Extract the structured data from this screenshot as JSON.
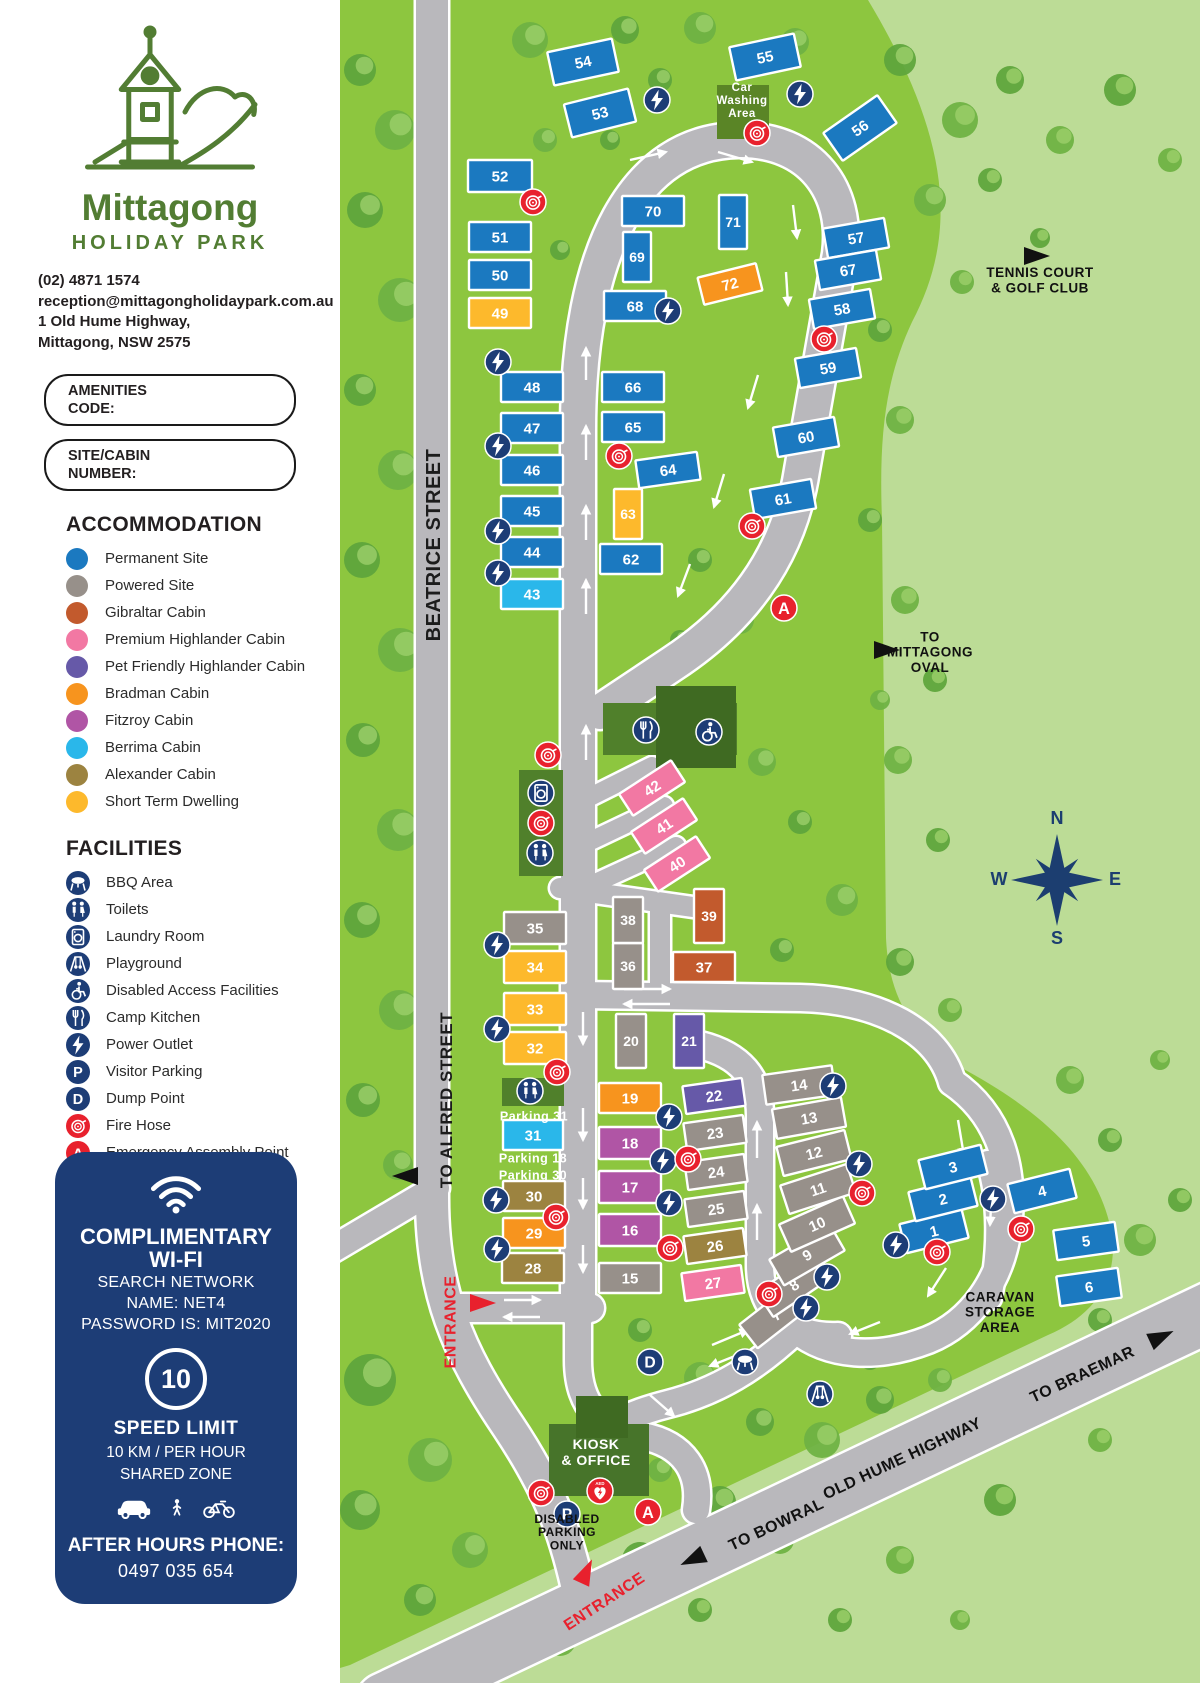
{
  "brand": {
    "name": "Mittagong",
    "subtitle": "HOLIDAY PARK",
    "phone": "(02) 4871 1574",
    "email": "reception@mittagongholidaypark.com.au",
    "address1": "1 Old Hume Highway,",
    "address2": "Mittagong, NSW 2575"
  },
  "forms": {
    "amenities_label": "AMENITIES\nCODE:",
    "site_label": "SITE/CABIN\nNUMBER:"
  },
  "legend": {
    "accommodation_title": "ACCOMMODATION",
    "accommodation": [
      {
        "label": "Permanent Site",
        "color": "#1b79c0"
      },
      {
        "label": "Powered Site",
        "color": "#97908a"
      },
      {
        "label": "Gibraltar Cabin",
        "color": "#c25a2d"
      },
      {
        "label": "Premium Highlander Cabin",
        "color": "#f278a3"
      },
      {
        "label": "Pet Friendly Highlander Cabin",
        "color": "#6659a8"
      },
      {
        "label": "Bradman Cabin",
        "color": "#f7941e"
      },
      {
        "label": "Fitzroy Cabin",
        "color": "#b055a5"
      },
      {
        "label": "Berrima Cabin",
        "color": "#2ab7ea"
      },
      {
        "label": "Alexander Cabin",
        "color": "#9c8340"
      },
      {
        "label": "Short Term Dwelling",
        "color": "#fdb92c"
      }
    ],
    "facilities_title": "FACILITIES",
    "facilities": [
      {
        "label": "BBQ Area",
        "icon": "bbq",
        "color": "#1d3d76"
      },
      {
        "label": "Toilets",
        "icon": "toilets",
        "color": "#1d3d76"
      },
      {
        "label": "Laundry Room",
        "icon": "laundry",
        "color": "#1d3d76"
      },
      {
        "label": "Playground",
        "icon": "playground",
        "color": "#1d3d76"
      },
      {
        "label": "Disabled Access Facilities",
        "icon": "disabled",
        "color": "#1d3d76"
      },
      {
        "label": "Camp Kitchen",
        "icon": "kitchen",
        "color": "#1d3d76"
      },
      {
        "label": "Power Outlet",
        "icon": "power",
        "color": "#1d3d76"
      },
      {
        "label": "Visitor Parking",
        "icon": "parking",
        "color": "#1d3d76"
      },
      {
        "label": "Dump Point",
        "icon": "dump",
        "color": "#1d3d76"
      },
      {
        "label": "Fire Hose",
        "icon": "fire",
        "color": "#e8212d"
      },
      {
        "label": "Emergency Assembly Point",
        "icon": "assembly",
        "color": "#e8212d"
      },
      {
        "label": "Defibrillator",
        "icon": "defib",
        "color": "#e8212d"
      }
    ]
  },
  "wifi_card": {
    "title": "COMPLIMENTARY\nWI-FI",
    "line1": "SEARCH NETWORK",
    "line2": "NAME: NET4",
    "line3": "PASSWORD IS: MIT2020",
    "speed_value": "10",
    "speed_title": "SPEED LIMIT",
    "speed_line1": "10 KM / PER HOUR",
    "speed_line2": "SHARED ZONE",
    "after_hours_label": "AFTER HOURS PHONE:",
    "after_hours_phone": "0497 035 654"
  },
  "map": {
    "site_colors": {
      "permanent": "#1b79c0",
      "powered": "#97908a",
      "gibraltar": "#c25a2d",
      "premium": "#f278a3",
      "pet": "#6659a8",
      "bradman": "#f7941e",
      "fitzroy": "#b055a5",
      "berrima": "#2ab7ea",
      "alexander": "#9c8340",
      "short": "#fdb92c"
    },
    "sites": [
      [
        1,
        "permanent",
        934,
        1231,
        64,
        30,
        -14
      ],
      [
        2,
        "permanent",
        943,
        1199,
        64,
        30,
        -14
      ],
      [
        3,
        "permanent",
        953,
        1167,
        64,
        30,
        -14
      ],
      [
        4,
        "permanent",
        1042,
        1191,
        64,
        30,
        -14
      ],
      [
        5,
        "permanent",
        1086,
        1241,
        62,
        30,
        -8
      ],
      [
        6,
        "permanent",
        1089,
        1287,
        62,
        30,
        -8
      ],
      [
        7,
        "powered",
        776,
        1315,
        70,
        30,
        -38
      ],
      [
        8,
        "powered",
        794,
        1285,
        70,
        30,
        -34
      ],
      [
        9,
        "powered",
        807,
        1255,
        70,
        30,
        -30
      ],
      [
        10,
        "powered",
        817,
        1224,
        70,
        30,
        -24
      ],
      [
        11,
        "powered",
        818,
        1189,
        70,
        30,
        -18
      ],
      [
        12,
        "powered",
        814,
        1153,
        70,
        30,
        -14
      ],
      [
        13,
        "powered",
        809,
        1118,
        70,
        30,
        -10
      ],
      [
        14,
        "powered",
        799,
        1085,
        70,
        30,
        -8
      ],
      [
        15,
        "powered",
        630,
        1278,
        62,
        30,
        0
      ],
      [
        16,
        "fitzroy",
        630,
        1230,
        62,
        32,
        0
      ],
      [
        17,
        "fitzroy",
        630,
        1187,
        62,
        32,
        0
      ],
      [
        18,
        "fitzroy",
        630,
        1143,
        62,
        32,
        0
      ],
      [
        19,
        "bradman",
        630,
        1098,
        62,
        30,
        0
      ],
      [
        20,
        "powered",
        631,
        1041,
        30,
        54,
        0
      ],
      [
        21,
        "pet",
        689,
        1041,
        30,
        54,
        0
      ],
      [
        22,
        "pet",
        714,
        1096,
        60,
        28,
        -8
      ],
      [
        23,
        "powered",
        715,
        1133,
        60,
        28,
        -8
      ],
      [
        24,
        "powered",
        716,
        1172,
        60,
        28,
        -8
      ],
      [
        25,
        "powered",
        716,
        1209,
        60,
        28,
        -8
      ],
      [
        26,
        "alexander",
        715,
        1246,
        60,
        28,
        -8
      ],
      [
        27,
        "premium",
        713,
        1283,
        60,
        28,
        -8
      ],
      [
        28,
        "alexander",
        533,
        1268,
        62,
        30,
        0
      ],
      [
        29,
        "bradman",
        534,
        1233,
        62,
        30,
        0
      ],
      [
        30,
        "alexander",
        534,
        1196,
        62,
        30,
        0
      ],
      [
        31,
        "berrima",
        533,
        1135,
        60,
        30,
        0
      ],
      [
        32,
        "short",
        535,
        1048,
        62,
        32,
        0
      ],
      [
        33,
        "short",
        535,
        1009,
        62,
        32,
        0
      ],
      [
        34,
        "short",
        535,
        967,
        62,
        32,
        0
      ],
      [
        35,
        "powered",
        535,
        928,
        62,
        32,
        0
      ],
      [
        36,
        "powered",
        628,
        966,
        30,
        46,
        0
      ],
      [
        37,
        "gibraltar",
        704,
        967,
        62,
        30,
        0
      ],
      [
        38,
        "powered",
        628,
        920,
        30,
        46,
        0
      ],
      [
        39,
        "gibraltar",
        709,
        916,
        30,
        54,
        0
      ],
      [
        40,
        "premium",
        677,
        864,
        62,
        26,
        -33
      ],
      [
        41,
        "premium",
        664,
        826,
        62,
        26,
        -33
      ],
      [
        42,
        "premium",
        652,
        788,
        62,
        26,
        -33
      ],
      [
        43,
        "berrima",
        532,
        594,
        62,
        30,
        0
      ],
      [
        44,
        "permanent",
        532,
        552,
        62,
        30,
        0
      ],
      [
        45,
        "permanent",
        532,
        511,
        62,
        30,
        0
      ],
      [
        46,
        "permanent",
        532,
        470,
        62,
        30,
        0
      ],
      [
        47,
        "permanent",
        532,
        428,
        62,
        30,
        0
      ],
      [
        48,
        "permanent",
        532,
        387,
        62,
        30,
        0
      ],
      [
        49,
        "short",
        500,
        313,
        62,
        30,
        0
      ],
      [
        50,
        "permanent",
        500,
        275,
        62,
        30,
        0
      ],
      [
        51,
        "permanent",
        500,
        237,
        62,
        30,
        0
      ],
      [
        52,
        "permanent",
        500,
        176,
        64,
        32,
        0
      ],
      [
        53,
        "permanent",
        600,
        113,
        66,
        34,
        -14
      ],
      [
        54,
        "permanent",
        583,
        62,
        66,
        34,
        -12
      ],
      [
        55,
        "permanent",
        765,
        57,
        66,
        34,
        -12
      ],
      [
        56,
        "permanent",
        860,
        128,
        66,
        34,
        -35
      ],
      [
        57,
        "permanent",
        856,
        238,
        62,
        30,
        -10
      ],
      [
        58,
        "permanent",
        842,
        309,
        62,
        30,
        -10
      ],
      [
        59,
        "permanent",
        828,
        368,
        62,
        30,
        -10
      ],
      [
        60,
        "permanent",
        806,
        437,
        62,
        30,
        -10
      ],
      [
        61,
        "permanent",
        783,
        499,
        62,
        30,
        -10
      ],
      [
        62,
        "permanent",
        631,
        559,
        62,
        30,
        0
      ],
      [
        63,
        "short",
        628,
        514,
        28,
        50,
        0
      ],
      [
        64,
        "permanent",
        668,
        470,
        62,
        28,
        -8
      ],
      [
        65,
        "permanent",
        633,
        427,
        62,
        30,
        0
      ],
      [
        66,
        "permanent",
        633,
        387,
        62,
        30,
        0
      ],
      [
        67,
        "permanent",
        848,
        270,
        62,
        30,
        -10
      ],
      [
        68,
        "permanent",
        635,
        306,
        62,
        30,
        0
      ],
      [
        69,
        "permanent",
        637,
        257,
        28,
        50,
        0
      ],
      [
        70,
        "permanent",
        653,
        211,
        62,
        30,
        0
      ],
      [
        71,
        "permanent",
        733,
        222,
        28,
        54,
        0
      ],
      [
        72,
        "bradman",
        730,
        284,
        60,
        28,
        -14
      ]
    ],
    "icons": [
      [
        "power",
        657,
        100
      ],
      [
        "power",
        800,
        94
      ],
      [
        "power",
        668,
        311
      ],
      [
        "power",
        498,
        362
      ],
      [
        "power",
        498,
        446
      ],
      [
        "power",
        498,
        531
      ],
      [
        "power",
        498,
        573
      ],
      [
        "power",
        497,
        945
      ],
      [
        "power",
        497,
        1029
      ],
      [
        "power",
        496,
        1200
      ],
      [
        "power",
        497,
        1249
      ],
      [
        "power",
        669,
        1117
      ],
      [
        "power",
        663,
        1161
      ],
      [
        "power",
        669,
        1203
      ],
      [
        "power",
        833,
        1086
      ],
      [
        "power",
        859,
        1164
      ],
      [
        "power",
        827,
        1277
      ],
      [
        "power",
        806,
        1308
      ],
      [
        "power",
        896,
        1245
      ],
      [
        "power",
        993,
        1199
      ],
      [
        "fire",
        757,
        133
      ],
      [
        "fire",
        533,
        202
      ],
      [
        "fire",
        824,
        339
      ],
      [
        "fire",
        619,
        456
      ],
      [
        "fire",
        752,
        526
      ],
      [
        "fire",
        548,
        755
      ],
      [
        "fire",
        541,
        823
      ],
      [
        "fire",
        557,
        1072
      ],
      [
        "fire",
        688,
        1159
      ],
      [
        "fire",
        556,
        1217
      ],
      [
        "fire",
        670,
        1248
      ],
      [
        "fire",
        769,
        1294
      ],
      [
        "fire",
        862,
        1193
      ],
      [
        "fire",
        937,
        1252
      ],
      [
        "fire",
        1021,
        1229
      ],
      [
        "fire",
        541,
        1493
      ],
      [
        "toilets",
        540,
        853
      ],
      [
        "toilets",
        530,
        1091
      ],
      [
        "laundry",
        541,
        793
      ],
      [
        "kitchen",
        646,
        730
      ],
      [
        "disabled",
        709,
        732
      ],
      [
        "assembly",
        784,
        608
      ],
      [
        "assembly",
        648,
        1512
      ],
      [
        "defib",
        600,
        1491
      ],
      [
        "parking",
        567,
        1514
      ],
      [
        "dump",
        650,
        1362
      ],
      [
        "bbq",
        745,
        1362
      ],
      [
        "playground",
        820,
        1394
      ]
    ],
    "labels": [
      {
        "t": "BEATRICE STREET",
        "x": 433,
        "y": 545,
        "rot": -90,
        "s": 20,
        "c": "#1c1c1c",
        "w": 700
      },
      {
        "t": "TO ALFRED STREET",
        "x": 446,
        "y": 1100,
        "rot": -90,
        "s": 17,
        "c": "#1c1c1c",
        "w": 700
      },
      {
        "t": "ENTRANCE",
        "x": 450,
        "y": 1322,
        "rot": -90,
        "s": 16,
        "c": "#e8212d",
        "w": 800
      },
      {
        "t": "ENTRANCE",
        "x": 604,
        "y": 1601,
        "rot": -33,
        "s": 16,
        "c": "#e8212d",
        "w": 800
      },
      {
        "t": "Car\nWashing\nArea",
        "x": 742,
        "y": 100,
        "rot": 0,
        "s": 11.5,
        "c": "#ffffff",
        "w": 600
      },
      {
        "t": "TENNIS COURT\n& GOLF CLUB",
        "x": 1040,
        "y": 280,
        "rot": 0,
        "s": 13.5,
        "c": "#111111",
        "w": 700
      },
      {
        "t": "TO\nMITTAGONG\nOVAL",
        "x": 930,
        "y": 652,
        "rot": 0,
        "s": 13.5,
        "c": "#111111",
        "w": 700
      },
      {
        "t": "CARAVAN\nSTORAGE\nAREA",
        "x": 1000,
        "y": 1312,
        "rot": 0,
        "s": 13.5,
        "c": "#111111",
        "w": 700
      },
      {
        "t": "TO BRAEMAR",
        "x": 1082,
        "y": 1374,
        "rot": -25,
        "s": 16,
        "c": "#111111",
        "w": 700
      },
      {
        "t": "OLD HUME HIGHWAY",
        "x": 902,
        "y": 1458,
        "rot": -25,
        "s": 16,
        "c": "#111111",
        "w": 700
      },
      {
        "t": "TO BOWRAL",
        "x": 776,
        "y": 1524,
        "rot": -25,
        "s": 16,
        "c": "#111111",
        "w": 700
      },
      {
        "t": "KIOSK\n& OFFICE",
        "x": 596,
        "y": 1452,
        "rot": 0,
        "s": 14,
        "c": "#ffffff",
        "w": 700
      },
      {
        "t": "DISABLED\nPARKING\nONLY",
        "x": 567,
        "y": 1532,
        "rot": 0,
        "s": 12,
        "c": "#111111",
        "w": 700
      },
      {
        "t": "Parking 31",
        "x": 534,
        "y": 1116,
        "rot": 0,
        "s": 12.5,
        "c": "#ffffff",
        "w": 600
      },
      {
        "t": "Parking 18",
        "x": 533,
        "y": 1158,
        "rot": 0,
        "s": 12.5,
        "c": "#ffffff",
        "w": 600
      },
      {
        "t": "Parking 30",
        "x": 533,
        "y": 1175,
        "rot": 0,
        "s": 12.5,
        "c": "#ffffff",
        "w": 600
      }
    ],
    "flags": [
      {
        "c": "#111111",
        "x": 1024,
        "y": 256,
        "rot": 0
      },
      {
        "c": "#111111",
        "x": 874,
        "y": 650,
        "rot": 0
      },
      {
        "c": "#111111",
        "x": 418,
        "y": 1176,
        "rot": 180
      },
      {
        "c": "#111111",
        "x": 704,
        "y": 1554,
        "rot": 155
      },
      {
        "c": "#111111",
        "x": 1150,
        "y": 1342,
        "rot": -25
      },
      {
        "c": "#e8212d",
        "x": 470,
        "y": 1303,
        "rot": 0
      },
      {
        "c": "#e8212d",
        "x": 581,
        "y": 1583,
        "rot": -65
      }
    ],
    "compass": {
      "x": 1057,
      "y": 880,
      "n": "N",
      "e": "E",
      "s": "S",
      "w": "W",
      "color": "#1c3e70"
    }
  }
}
